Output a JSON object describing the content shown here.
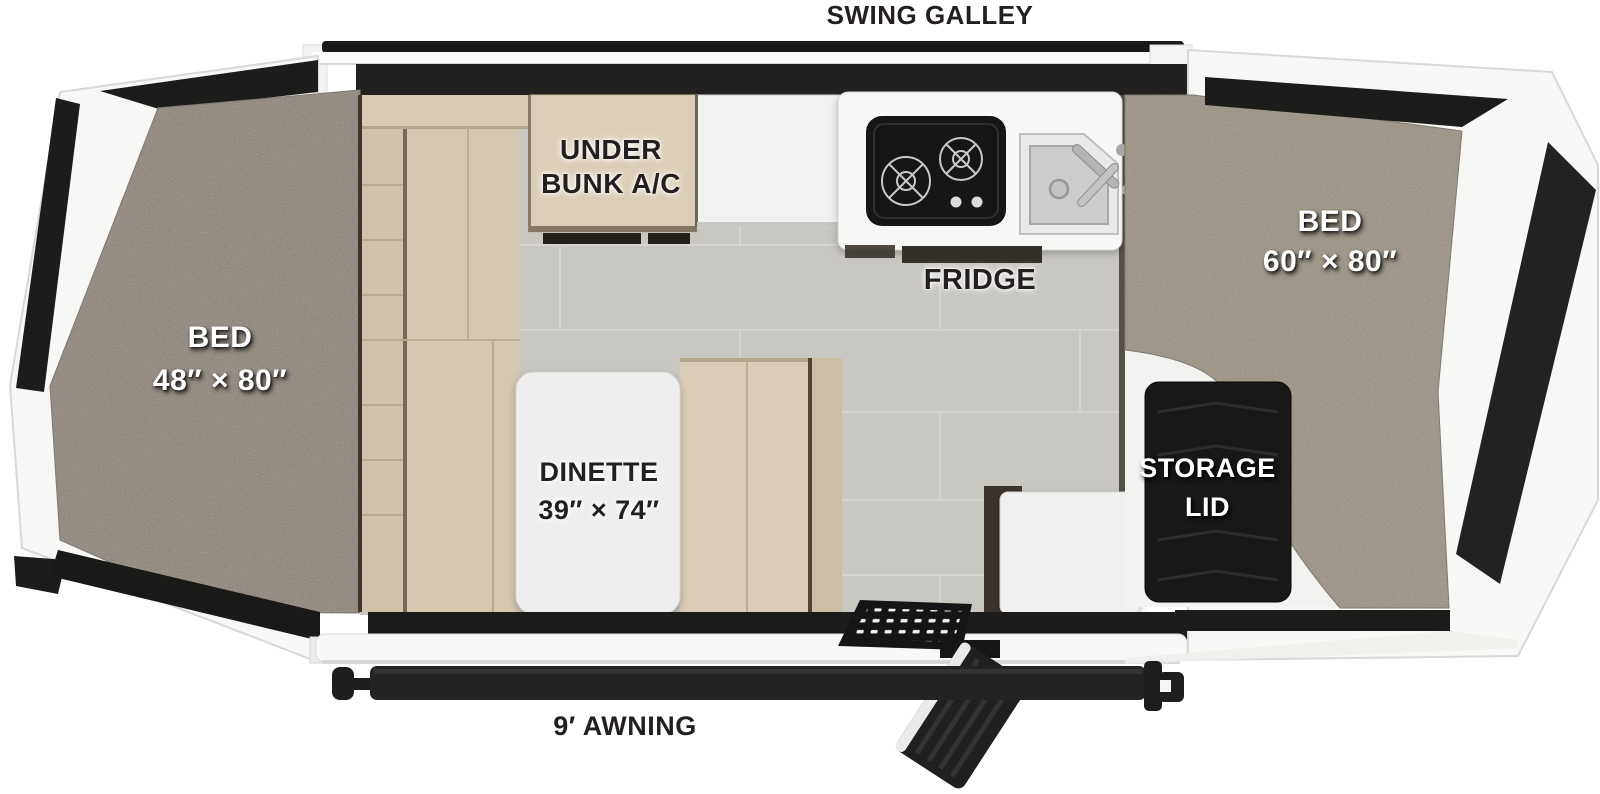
{
  "features": {
    "swing_galley": {
      "label": "SWING GALLEY"
    },
    "under_bunk_ac": {
      "line1": "UNDER",
      "line2": "BUNK A/C"
    },
    "fridge": {
      "label": "FRIDGE"
    },
    "bed_front": {
      "line1": "BED",
      "line2": "48″ × 80″"
    },
    "bed_rear": {
      "line1": "BED",
      "line2": "60″ × 80″"
    },
    "dinette": {
      "line1": "DINETTE",
      "line2": "39″ × 74″"
    },
    "storage_lid": {
      "line1": "STORAGE",
      "line2": "LID"
    },
    "awning": {
      "label": "9′ AWNING"
    }
  },
  "colors": {
    "background": "#ffffff",
    "canvas_black": "#1b1b1a",
    "body_white": "#f7f7f6",
    "carpet_front": "#8d8377",
    "carpet_rear": "#99907f",
    "sofa_tan": "#d5c8b1",
    "floor_tile": "#c9c7c2",
    "storage_panel": "#181818",
    "label_dark": "#231f20",
    "label_light": "#ffffff"
  }
}
